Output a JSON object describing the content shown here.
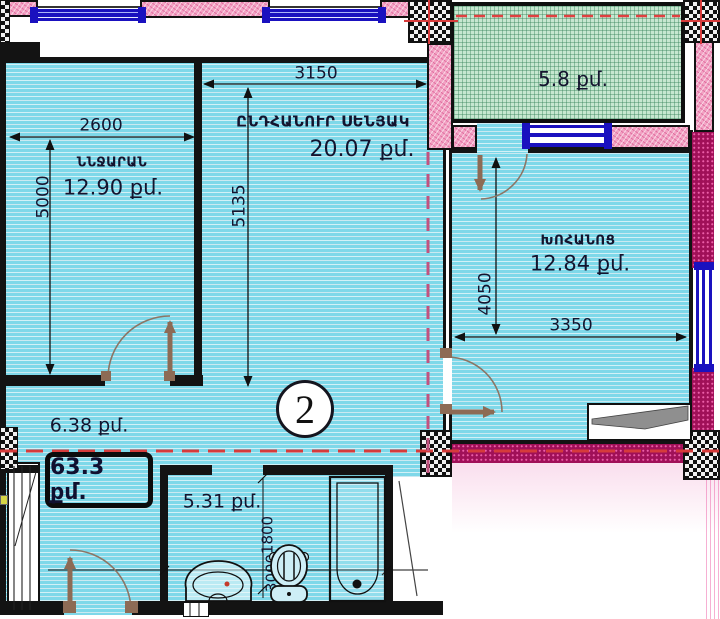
{
  "plan": {
    "unit_number": "2",
    "total_area": "63.3 քմ.",
    "rooms": {
      "bedroom": {
        "name": "ՆՆՋԱՐԱՆ",
        "area": "12.90 քմ."
      },
      "living": {
        "name": "ԸՆԴՀԱՆՈՒՐ ՍԵՆՅԱԿ",
        "area": "20.07 քմ."
      },
      "kitchen": {
        "name": "ԽՈՀԱՆՈՑ",
        "area": "12.84 քմ."
      },
      "balcony": {
        "area": "5.8 քմ."
      },
      "hallway": {
        "area": "6.38 քմ."
      },
      "bathroom": {
        "area": "5.31 քմ."
      }
    },
    "dimensions_mm": {
      "bedroom_width": "2600",
      "bedroom_depth": "5000",
      "living_width": "3150",
      "living_depth": "5135",
      "kitchen_depth": "4050",
      "kitchen_width": "3350",
      "bathroom_depth": "1800",
      "bathroom_width": "3000"
    },
    "colors": {
      "room_fill": "#7ed8e9",
      "balcony_fill": "#c6e7d0",
      "wall_pink": "#f2a2c3",
      "wall_magenta": "#a01058",
      "window_blue": "#1a11bf",
      "door_brown": "#8d6b55",
      "axis_red": "#d63b3b"
    }
  }
}
